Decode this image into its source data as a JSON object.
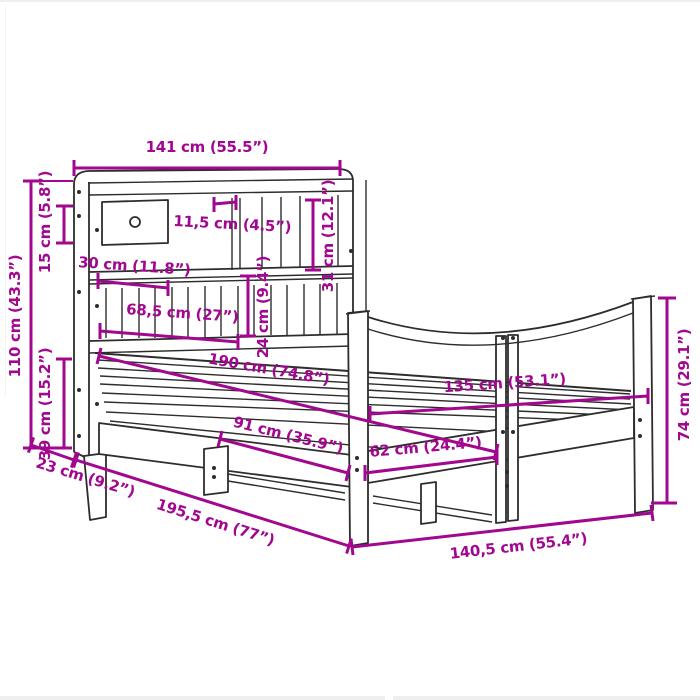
{
  "page": {
    "type": "product-dimension-diagram",
    "subject": "bed-frame-with-bookcase-headboard",
    "background": "#ffffff"
  },
  "colors": {
    "dimension_annotation": "#A1088F",
    "drawing_line": "#2d2d2d"
  },
  "dimensions": {
    "headboard_width": "141 cm (55.5”)",
    "headboard_top_offset": "15 cm (5.8”)",
    "total_height": "110 cm (43.3”)",
    "base_height": "39 cm (15.2”)",
    "headboard_depth": "23 cm (9.2”)",
    "total_length": "195,5 cm (77”)",
    "slot_width": "11,5 cm (4.5”)",
    "upper_shelf_height": "31 cm (12.1”)",
    "lower_shelf_height": "24 cm (9.4”)",
    "compartment_width": "30 cm (11.8”)",
    "shelf_section_width": "68,5 cm (27”)",
    "inner_length": "190 cm (74.8”)",
    "front_leg_spacing": "91 cm (35.9”)",
    "end_leg_spacing": "62 cm (24.4”)",
    "inner_width": "135 cm (53.1”)",
    "footboard_height": "74 cm (29.1”)",
    "total_width": "140,5 cm (55.4”)"
  }
}
